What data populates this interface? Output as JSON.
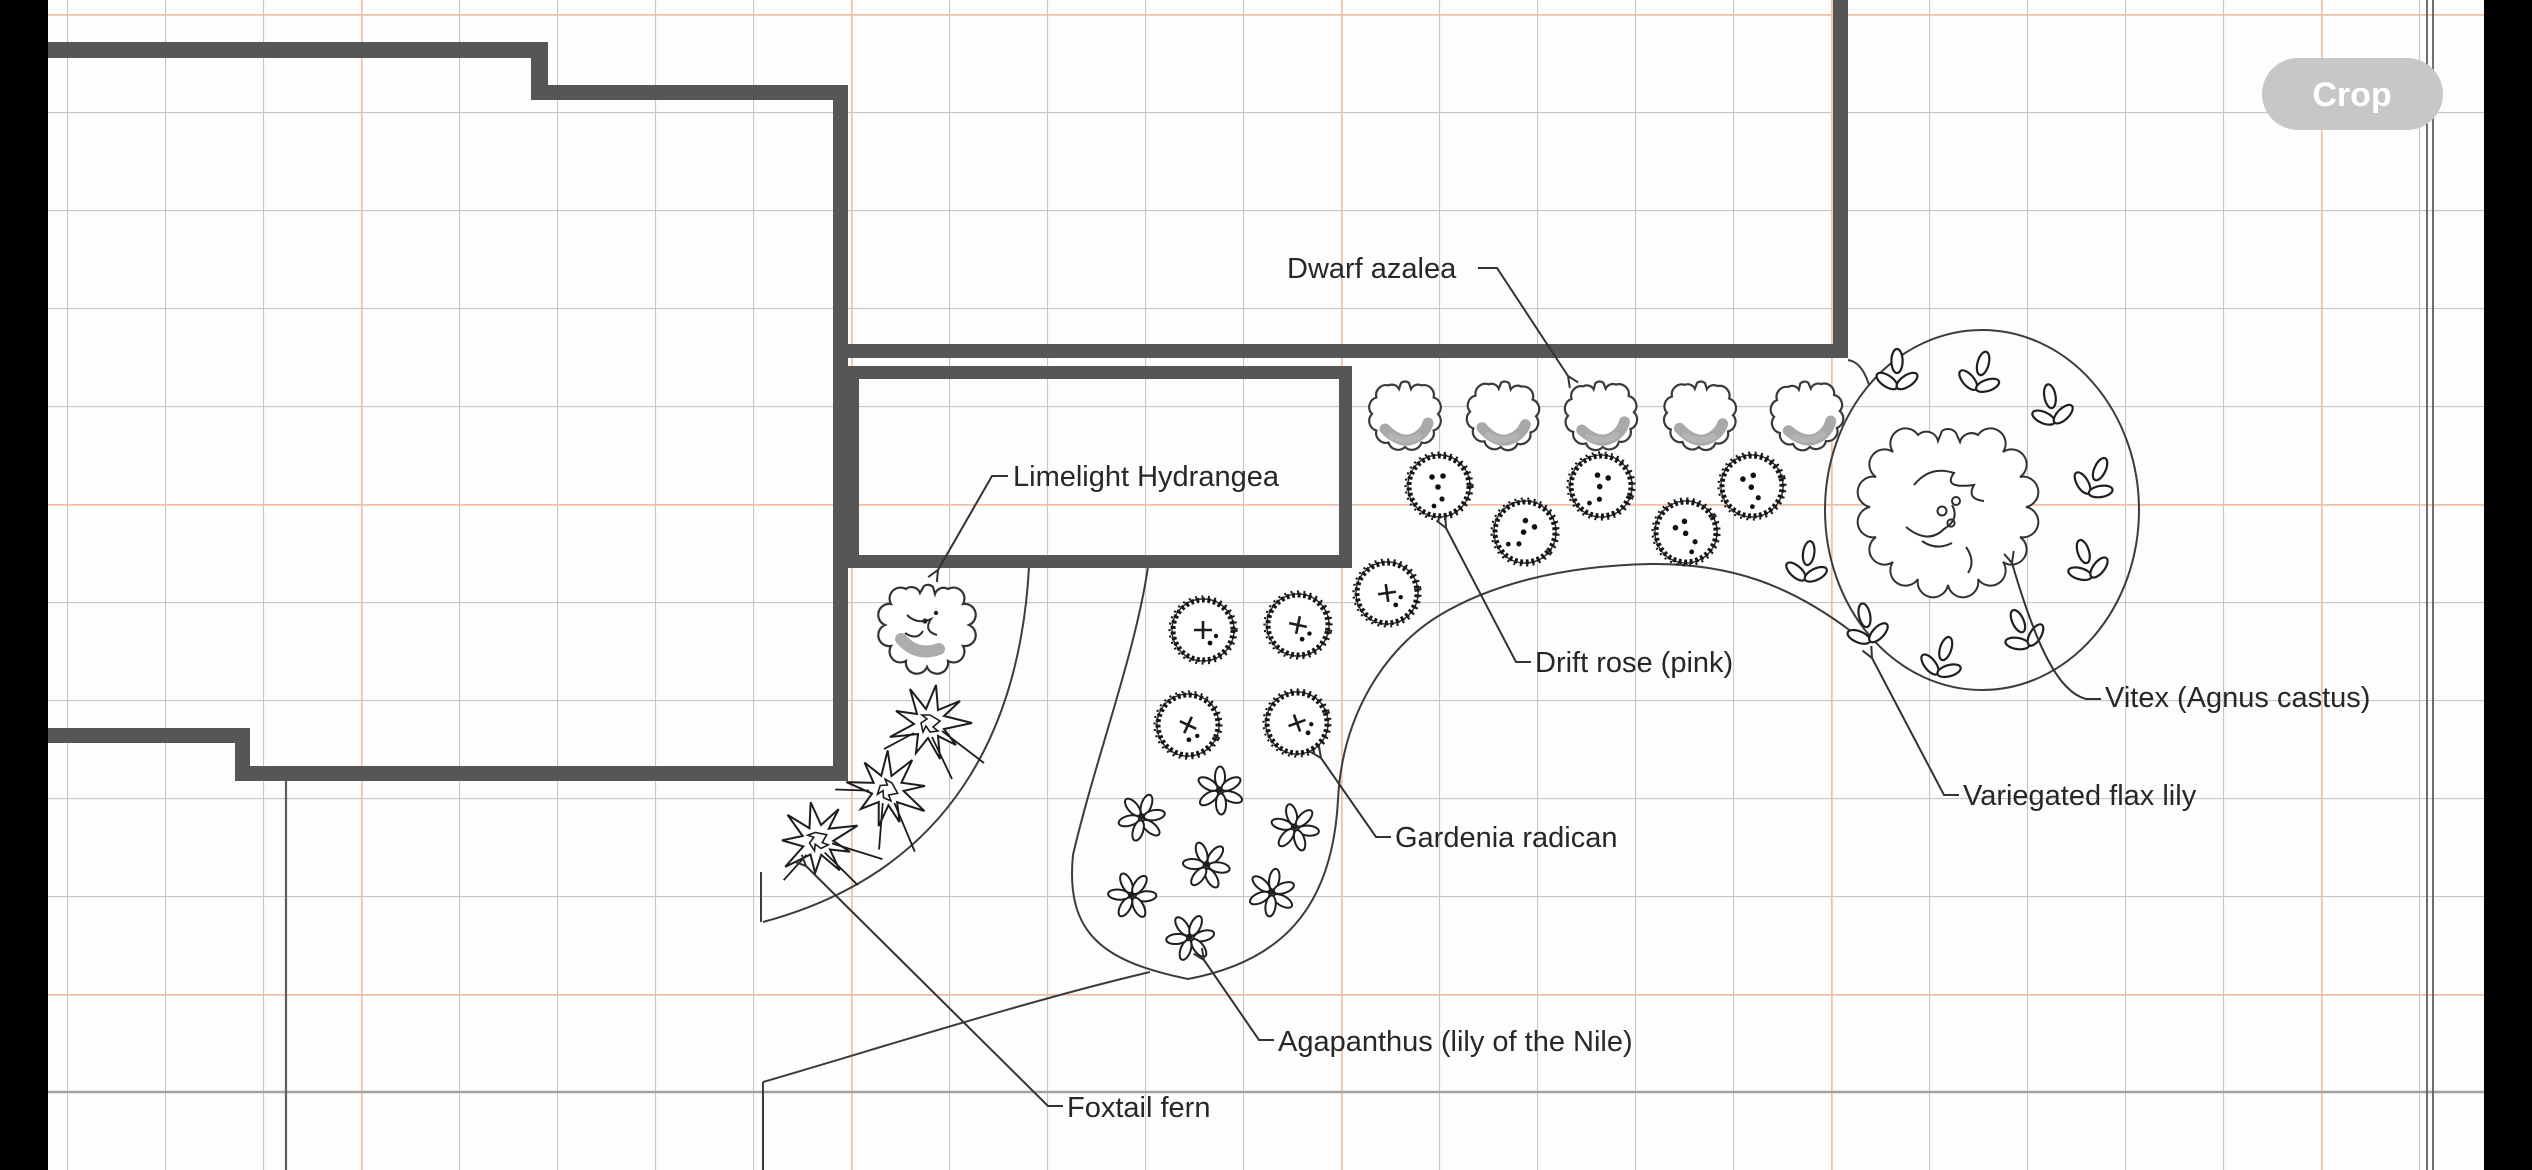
{
  "ui": {
    "crop_label": "Crop"
  },
  "plan": {
    "type": "landscape-planting-plan",
    "colors": {
      "wall": "#565656",
      "grid_minor": "#c6c6c6",
      "grid_major": "#f1bfa7",
      "line_work": "#3c3c3c",
      "shading": "#a9a9a9",
      "crop_button_bg": "#c7c7c7",
      "side_bars": "#000000"
    },
    "grid": {
      "minor_spacing_px": 98,
      "major_every": 5
    },
    "plants": [
      {
        "name": "Dwarf azalea",
        "count": 5,
        "symbol": "scalloped-shrub-circle-shaded"
      },
      {
        "name": "Limelight Hydrangea",
        "count": 1,
        "symbol": "scalloped-shrub-circle-detailed"
      },
      {
        "name": "Drift rose (pink)",
        "count": 5,
        "symbol": "rough-circle-with-dots"
      },
      {
        "name": "Vitex (Agnus castus)",
        "count": 1,
        "symbol": "large-irregular-canopy"
      },
      {
        "name": "Variegated flax lily",
        "count": 9,
        "symbol": "trefoil-leaf-cluster"
      },
      {
        "name": "Gardenia radican",
        "count": 5,
        "symbol": "rough-circle-with-plus"
      },
      {
        "name": "Agapanthus (lily of the Nile)",
        "count": 7,
        "symbol": "petal-flower-cluster"
      },
      {
        "name": "Foxtail fern",
        "count": 3,
        "symbol": "spiky-starburst"
      }
    ]
  }
}
